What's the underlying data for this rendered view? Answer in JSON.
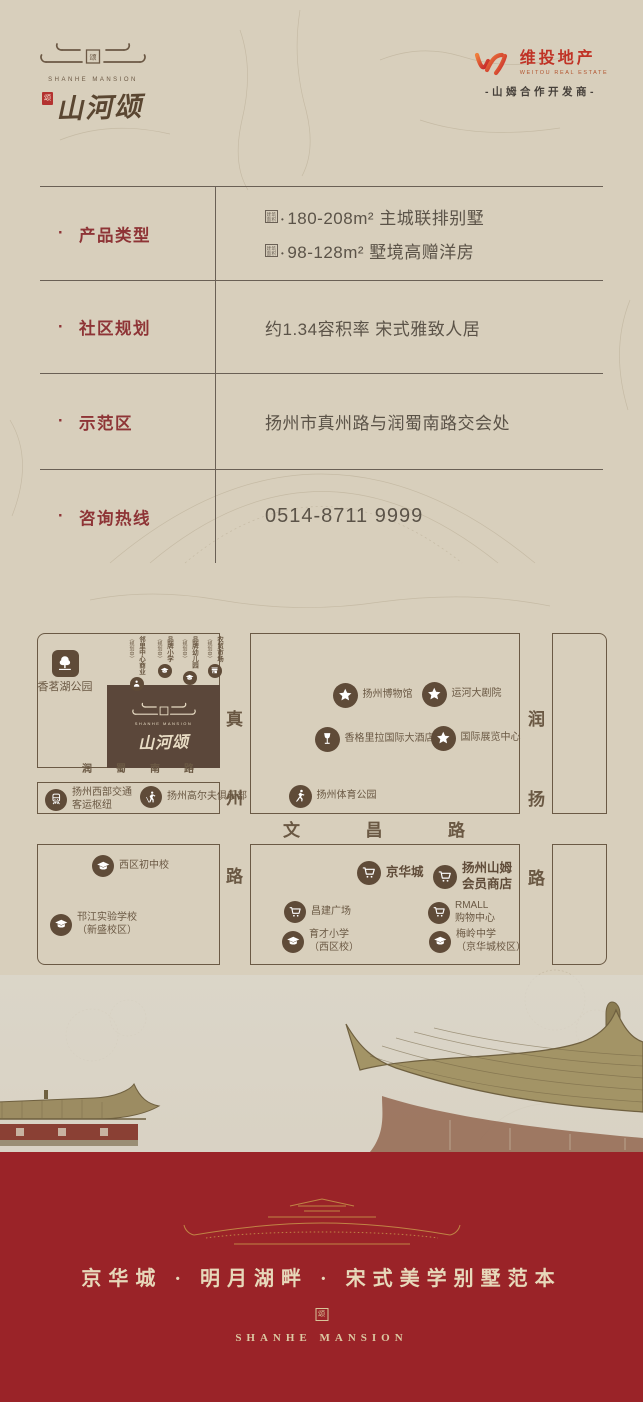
{
  "brand": {
    "name_en": "SHANHE MANSION",
    "name_cn": "山河颂",
    "seal_char": "颂"
  },
  "developer": {
    "name_cn": "维投地产",
    "name_en": "WEITOU REAL ESTATE",
    "partner_line": "-山姆合作开发商-"
  },
  "info_table": {
    "rows": [
      {
        "label": "产品类型",
        "values": [
          {
            "seal": "建筑面积",
            "text": "180-208m² 主城联排别墅"
          },
          {
            "seal": "建筑面积",
            "text": "98-128m² 墅境高赠洋房"
          }
        ]
      },
      {
        "label": "社区规划",
        "values": [
          {
            "text": "约1.34容积率 宋式雅致人居"
          }
        ]
      },
      {
        "label": "示范区",
        "values": [
          {
            "text": "扬州市真州路与润蜀南路交会处"
          }
        ]
      },
      {
        "label": "咨询热线",
        "values": [
          {
            "text": "0514-8711 9999"
          }
        ],
        "is_phone": true
      }
    ]
  },
  "map": {
    "project_box": {
      "name_en": "SHANHE MANSION",
      "name_cn": "山河颂"
    },
    "roads": [
      {
        "id": "runshu-south-road",
        "name": "润蜀南路",
        "orient": "h",
        "x": 45,
        "y": 127,
        "len": 112,
        "size": 10
      },
      {
        "id": "zhenzhou-road",
        "name": "真州路",
        "orient": "v",
        "x": 185,
        "y": 72,
        "len": 182,
        "size": 17
      },
      {
        "id": "wenchang-road",
        "name": "文昌路",
        "orient": "h",
        "x": 246,
        "y": 185,
        "len": 182,
        "size": 17
      },
      {
        "id": "runyang-road",
        "name": "润扬路",
        "orient": "v",
        "x": 487,
        "y": 72,
        "len": 184,
        "size": 17
      }
    ],
    "planned_labels": [
      {
        "id": "neighborhood-center",
        "label": "邻里中心商业",
        "note": "（规划中）",
        "icon": "person-icon",
        "x": 100
      },
      {
        "id": "brand-primary-school",
        "label": "品牌小学",
        "note": "（规划中）",
        "icon": "cap-icon",
        "x": 128
      },
      {
        "id": "brand-kindergarten",
        "label": "品牌幼儿园",
        "note": "（规划中）",
        "icon": "cap-icon",
        "x": 153
      },
      {
        "id": "farmers-market",
        "label": "农贸市场",
        "note": "（规划中）",
        "icon": "market-icon",
        "x": 178
      }
    ],
    "pois": [
      {
        "id": "xiangming-lake-park",
        "icon": "tree-icon",
        "x": 28,
        "y": 30,
        "size": 27,
        "shape": "rounded",
        "label_pos": "below",
        "lines": [
          "香茗湖公园"
        ]
      },
      {
        "id": "yangzhou-museum",
        "icon": "star-icon",
        "x": 308,
        "y": 62,
        "size": 25,
        "lines": [
          "扬州博物馆"
        ]
      },
      {
        "id": "canal-grand-theatre",
        "icon": "star-icon",
        "x": 397,
        "y": 61,
        "size": 25,
        "lines": [
          "运河大剧院"
        ]
      },
      {
        "id": "shangri-la-hotel",
        "icon": "wine-icon",
        "x": 290,
        "y": 106,
        "size": 25,
        "lines": [
          "香格里拉国际大酒店"
        ]
      },
      {
        "id": "intl-exhibition-center",
        "icon": "star-icon",
        "x": 406,
        "y": 105,
        "size": 25,
        "lines": [
          "国际展览中心"
        ]
      },
      {
        "id": "yangzhou-sports-park",
        "icon": "runner-icon",
        "x": 263,
        "y": 163,
        "size": 23,
        "lines": [
          "扬州体育公园"
        ]
      },
      {
        "id": "west-transport-hub",
        "icon": "train-icon",
        "x": 19,
        "y": 165,
        "size": 22,
        "lines": [
          "扬州西部交通",
          "客运枢纽"
        ]
      },
      {
        "id": "golf-club",
        "icon": "golf-icon",
        "x": 114,
        "y": 164,
        "size": 22,
        "lines": [
          "扬州高尔夫俱乐部"
        ]
      },
      {
        "id": "west-district-middle-school",
        "icon": "cap-icon",
        "x": 66,
        "y": 233,
        "size": 22,
        "lines": [
          "西区初中校"
        ]
      },
      {
        "id": "hanjiang-experimental-school",
        "icon": "cap-icon",
        "x": 24,
        "y": 290,
        "size": 22,
        "lines": [
          "邗江实验学校",
          "（新盛校区）"
        ]
      },
      {
        "id": "jinghua-city-mall",
        "icon": "cart-icon",
        "x": 332,
        "y": 240,
        "size": 24,
        "bold": true,
        "lines": [
          "京华城"
        ]
      },
      {
        "id": "sams-club-store",
        "icon": "cart-icon",
        "x": 408,
        "y": 240,
        "size": 24,
        "bold": true,
        "lines": [
          "扬州山姆",
          "会员商店"
        ]
      },
      {
        "id": "changjian-plaza",
        "icon": "cart-icon",
        "x": 258,
        "y": 279,
        "size": 22,
        "lines": [
          "昌建广场"
        ]
      },
      {
        "id": "rmall-shopping-center",
        "icon": "cart-icon",
        "x": 402,
        "y": 278,
        "size": 22,
        "lines": [
          "RMALL",
          "购物中心"
        ]
      },
      {
        "id": "yucai-primary-school",
        "icon": "cap-icon",
        "x": 256,
        "y": 307,
        "size": 22,
        "lines": [
          "育才小学",
          "（西区校）"
        ]
      },
      {
        "id": "meiling-middle-school",
        "icon": "cap-icon",
        "x": 403,
        "y": 307,
        "size": 22,
        "lines": [
          "梅岭中学",
          "（京华城校区）"
        ]
      }
    ]
  },
  "footer": {
    "tagline": "京华城 · 明月湖畔 · 宋式美学别墅范本",
    "brand_en": "SHANHE MANSION",
    "seal_char": "颂"
  },
  "colors": {
    "paper": "#d8cfbc",
    "band_red": "#9a2328",
    "label_red": "#8e3436",
    "map_brown": "#5f4b38",
    "gold": "#c08445"
  }
}
